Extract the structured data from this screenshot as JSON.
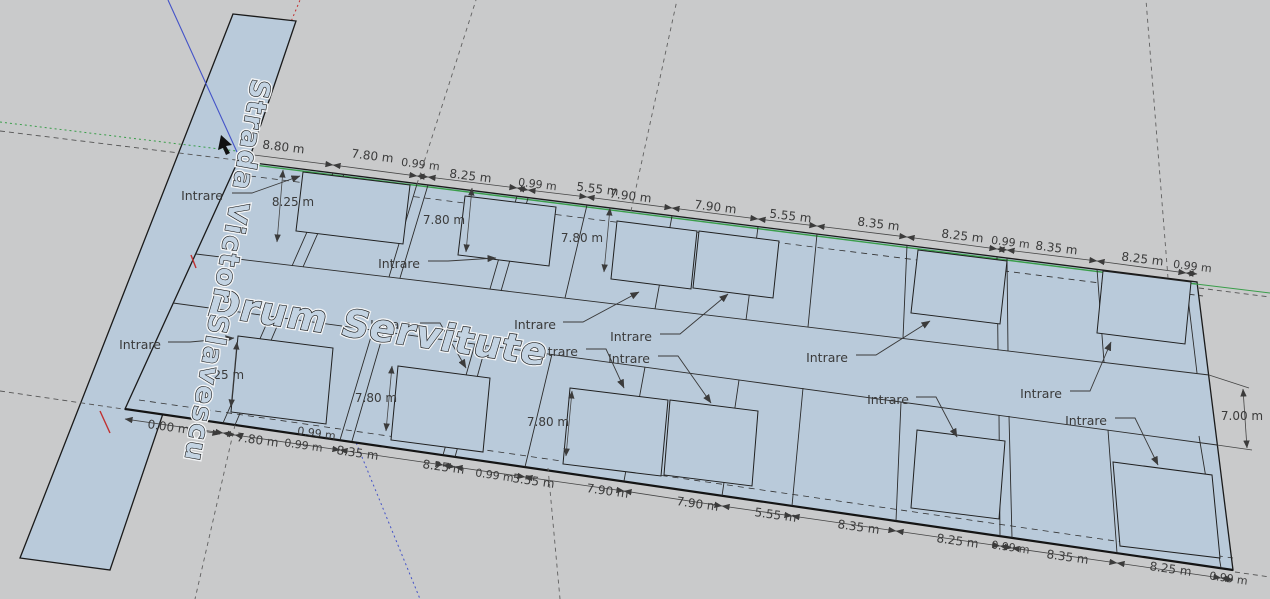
{
  "scene": {
    "street_name": "Strada Victor Slavescu",
    "road_name": "Drum Servitute"
  },
  "labels": {
    "entrance": "Intrare",
    "entrance_count": 12
  },
  "dimensions": {
    "top": [
      "8.80 m",
      "7.80 m",
      "0.99 m",
      "8.25 m",
      "0.99 m",
      "5.55 m",
      "7.90 m",
      "7.90 m",
      "5.55 m",
      "8.35 m",
      "8.25 m",
      "0.99 m",
      "8.35 m",
      "8.25 m",
      "0.99 m"
    ],
    "bottom_start": "0.00 m",
    "bottom_extra": "0.99 m",
    "bottom": [
      "7.80 m",
      "0.99 m",
      "8.35 m",
      "8.25 m",
      "0.99 m",
      "5.55 m",
      "7.90 m",
      "7.90 m",
      "5.55 m",
      "8.35 m",
      "8.25 m",
      "0.99 m",
      "8.35 m",
      "8.25 m",
      "0.99 m"
    ],
    "interior": [
      "8.25 m",
      "7.80 m",
      "7.80 m",
      "8.25 m",
      "7.80 m",
      "7.80 m"
    ],
    "road_width": "7.00 m"
  },
  "colors": {
    "background": "#c9cacb",
    "parcel_fill": "#b9cada",
    "street_fill": "#b9cada",
    "edge": "#1a1a1a",
    "axis_red": "#c03030",
    "axis_green": "#3a9e4a",
    "axis_blue": "#4453c8",
    "dim_text": "#3b3b3b",
    "guide": "#606060"
  }
}
